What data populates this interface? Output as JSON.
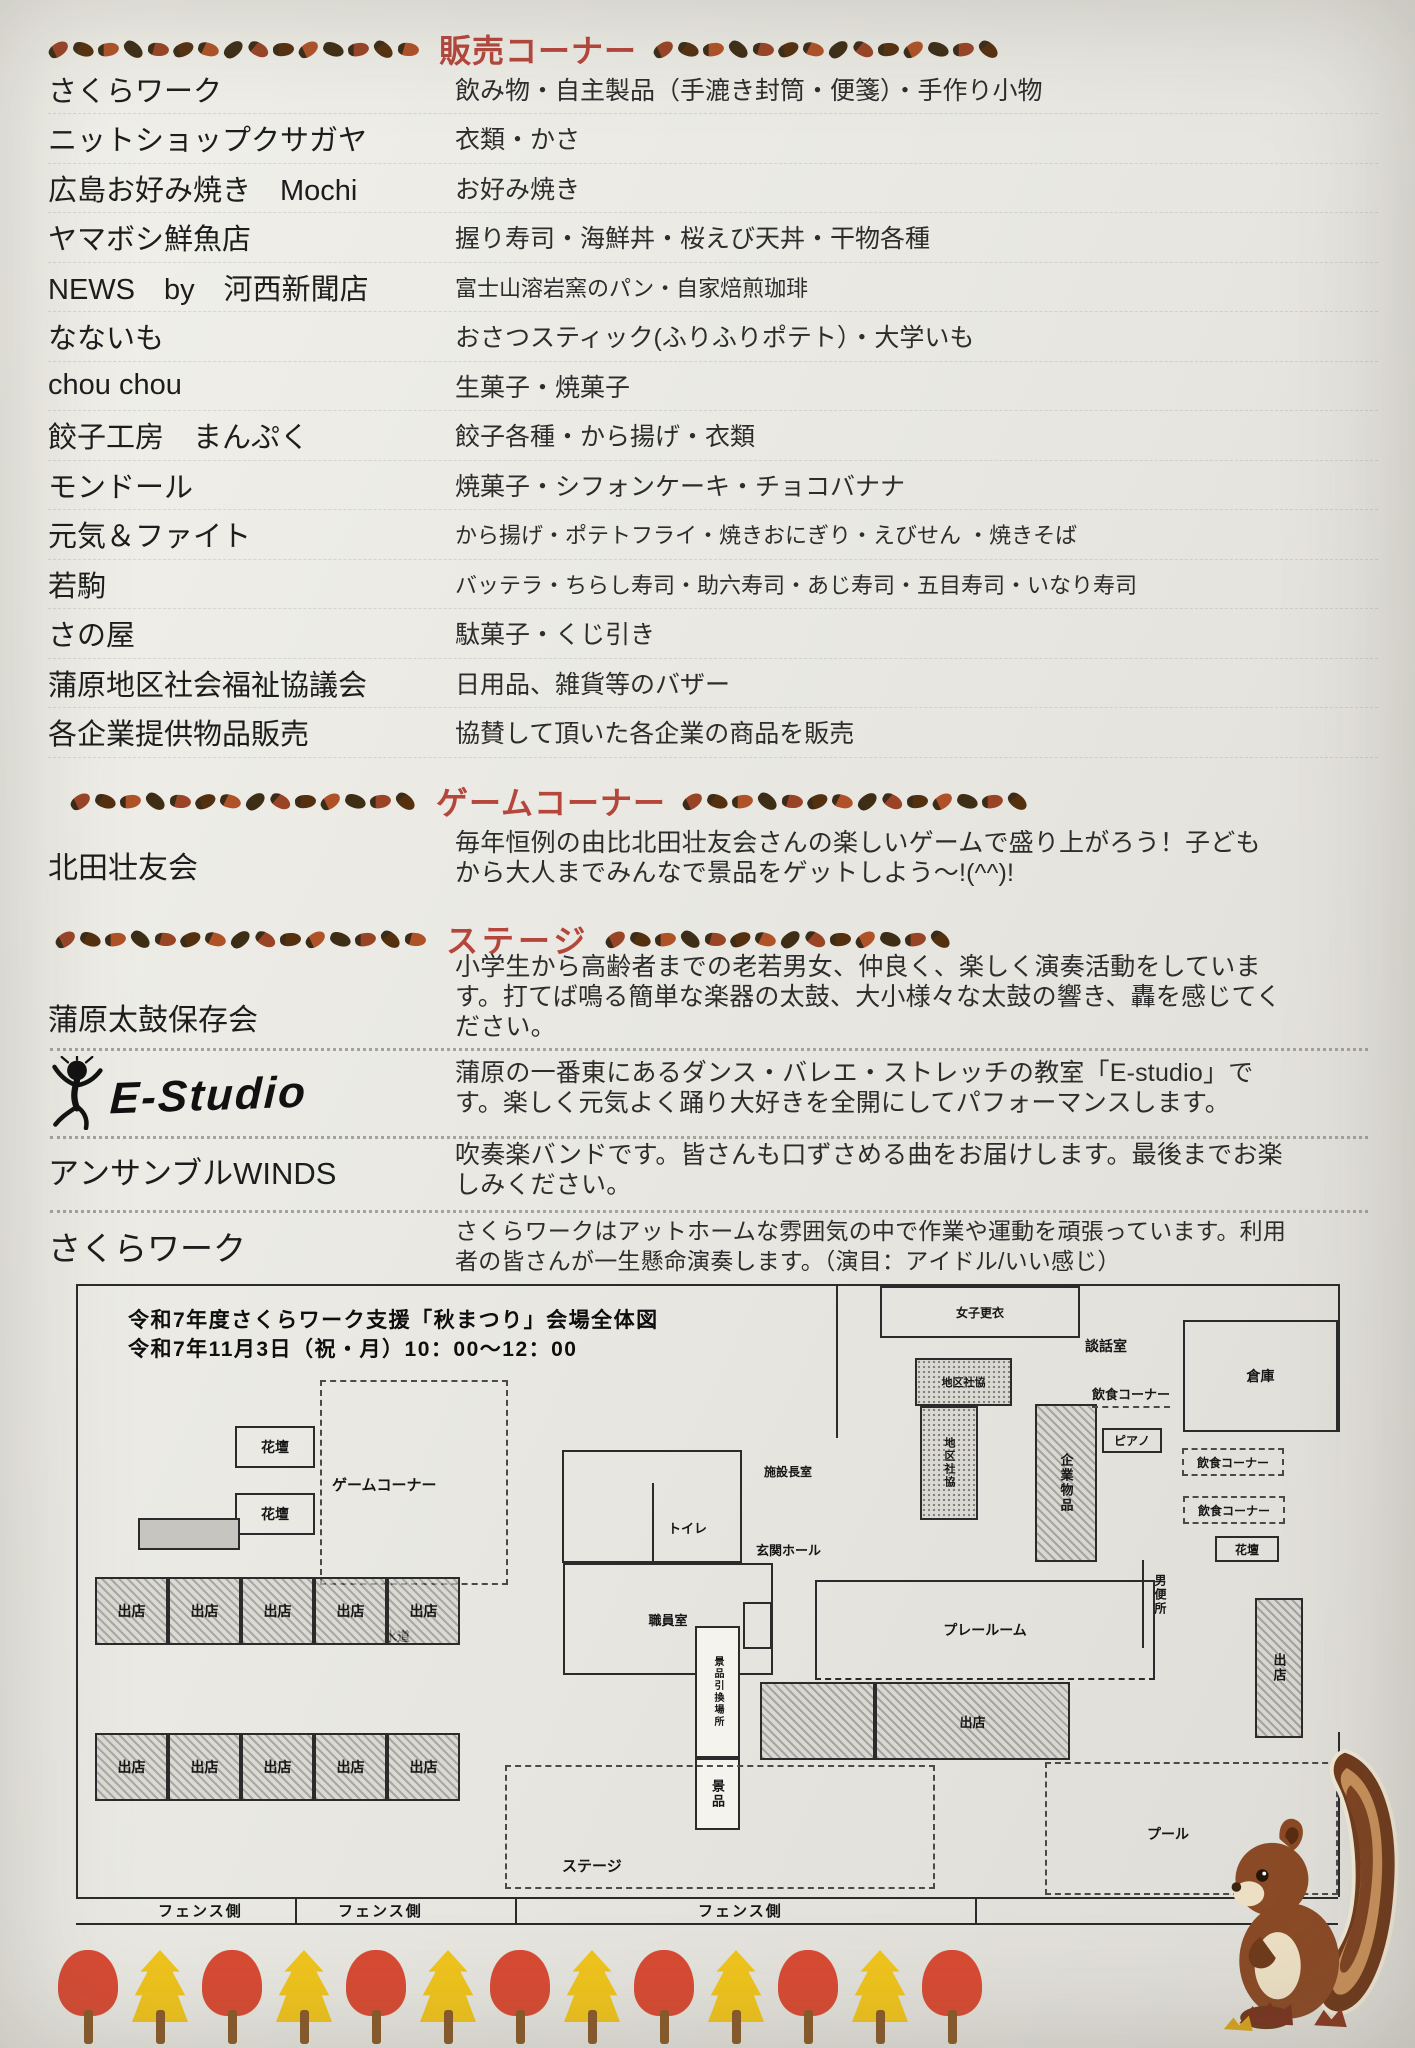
{
  "colors": {
    "paper": "#e9e8e2",
    "header_red": "#b5463c",
    "ink": "#222222",
    "map_line": "#2b2b2b",
    "tree_red": "#d84a33",
    "tree_yellow": "#f0c41c",
    "trunk_brown": "#8a5a2a",
    "acorn_palette": [
      "#9a4426",
      "#54300f",
      "#b05228",
      "#3f2e16"
    ],
    "squirrel_brown": "#8a4a26"
  },
  "sections": {
    "sales": {
      "title": "販売コーナー",
      "vendors": [
        {
          "name": "さくらワーク",
          "items": "飲み物・自主製品（手漉き封筒・便箋）・手作り小物"
        },
        {
          "name": "ニットショップクサガヤ",
          "items": "衣類・かさ"
        },
        {
          "name": "広島お好み焼き　Mochi",
          "items": "お好み焼き"
        },
        {
          "name": "ヤマボシ鮮魚店",
          "items": "握り寿司・海鮮丼・桜えび天丼・干物各種"
        },
        {
          "name": "NEWS　by　河西新聞店",
          "items": "富士山溶岩窯のパン・自家焙煎珈琲",
          "small": true
        },
        {
          "name": "なないも",
          "items": "おさつスティック(ふりふりポテト）・大学いも"
        },
        {
          "name": "chou chou",
          "items": "生菓子・焼菓子"
        },
        {
          "name": "餃子工房　まんぷく",
          "items": "餃子各種・から揚げ・衣類"
        },
        {
          "name": "モンドール",
          "items": "焼菓子・シフォンケーキ・チョコバナナ"
        },
        {
          "name": "元気＆ファイト",
          "items": "から揚げ・ポテトフライ・焼きおにぎり・えびせん ・焼きそば",
          "small": true
        },
        {
          "name": "若駒",
          "items": "バッテラ・ちらし寿司・助六寿司・あじ寿司・五目寿司・いなり寿司",
          "small": true
        },
        {
          "name": "さの屋",
          "items": "駄菓子・くじ引き"
        },
        {
          "name": "蒲原地区社会福祉協議会",
          "items": "日用品、雑貨等のバザー"
        },
        {
          "name": "各企業提供物品販売",
          "items": "協賛して頂いた各企業の商品を販売"
        }
      ]
    },
    "game": {
      "title": "ゲームコーナー",
      "performers": [
        {
          "name": "北田壮友会",
          "desc": "毎年恒例の由比北田壮友会さんの楽しいゲームで盛り上がろう！子どもから大人までみんなで景品をゲットしよう～!(^^)!"
        }
      ]
    },
    "stage": {
      "title": "ステージ",
      "performers": [
        {
          "name": "蒲原太鼓保存会",
          "desc": "小学生から高齢者までの老若男女、仲良く、楽しく演奏活動をしています。打てば鳴る簡単な楽器の太鼓、大小様々な太鼓の響き、轟を感じてください。"
        },
        {
          "name": "E-Studio",
          "logo": true,
          "logo_text": "E-Studio",
          "desc": "蒲原の一番東にあるダンス・バレエ・ストレッチの教室「E-studio」です。楽しく元気よく踊り大好きを全開にしてパフォーマンスします。"
        },
        {
          "name": "アンサンブルWINDS",
          "desc": "吹奏楽バンドです。皆さんも口ずさめる曲をお届けします。最後までお楽しみください。"
        },
        {
          "name": "さくらワーク",
          "desc": "さくらワークはアットホームな雰囲気の中で作業や運動を頑張っています。利用者の皆さんが一生懸命演奏します。（演目：アイドル/いい感じ）",
          "small": true
        }
      ]
    }
  },
  "map": {
    "title1": "令和7年度さくらワーク支援「秋まつり」会場全体図",
    "title2": "令和7年11月3日（祝・月）10：00～12：00",
    "stall_label": "出店",
    "fence_label": "フェンス側",
    "rooms": [
      {
        "label": "花壇",
        "x": 165,
        "y": 146,
        "w": 80,
        "h": 42,
        "s": "room",
        "fs": 14
      },
      {
        "label": "花壇",
        "x": 165,
        "y": 213,
        "w": 80,
        "h": 42,
        "s": "room",
        "fs": 14
      },
      {
        "label": "",
        "x": 68,
        "y": 238,
        "w": 102,
        "h": 32,
        "s": "gray"
      },
      {
        "label": "ゲームコーナー",
        "x": 250,
        "y": 100,
        "w": 188,
        "h": 205,
        "s": "dash",
        "fs": 15,
        "lx": 10,
        "ly": 92
      },
      {
        "label": "女子更衣",
        "x": 810,
        "y": 6,
        "w": 200,
        "h": 52,
        "s": "room",
        "fs": 12
      },
      {
        "label": "倉庫",
        "x": 1113,
        "y": 40,
        "w": 155,
        "h": 112,
        "s": "room",
        "fs": 14
      },
      {
        "label": "",
        "x": 492,
        "y": 170,
        "w": 180,
        "h": 113,
        "s": "room"
      },
      {
        "label": "職員室",
        "x": 493,
        "y": 283,
        "w": 210,
        "h": 112,
        "s": "room",
        "fs": 13
      },
      {
        "label": "",
        "x": 673,
        "y": 322,
        "w": 29,
        "h": 47,
        "s": "room"
      },
      {
        "label": "プレールーム",
        "x": 745,
        "y": 300,
        "w": 340,
        "h": 100,
        "s": "roomdb",
        "fs": 14
      },
      {
        "label": "地区社協",
        "x": 845,
        "y": 78,
        "w": 97,
        "h": 48,
        "s": "dots",
        "fs": 11
      },
      {
        "label": "地区社協",
        "x": 850,
        "y": 126,
        "w": 58,
        "h": 114,
        "s": "dots",
        "fs": 11,
        "v": true
      },
      {
        "label": "企業物品",
        "x": 965,
        "y": 124,
        "w": 62,
        "h": 158,
        "s": "hatch",
        "fs": 13,
        "v": true
      },
      {
        "label": "ピアノ",
        "x": 1032,
        "y": 148,
        "w": 60,
        "h": 25,
        "s": "room",
        "fs": 12
      },
      {
        "label": "飲食コーナー",
        "x": 1112,
        "y": 168,
        "w": 102,
        "h": 28,
        "s": "dash",
        "fs": 12
      },
      {
        "label": "飲食コーナー",
        "x": 1113,
        "y": 216,
        "w": 102,
        "h": 28,
        "s": "dash",
        "fs": 12
      },
      {
        "label": "花壇",
        "x": 1145,
        "y": 256,
        "w": 64,
        "h": 26,
        "s": "room",
        "fs": 12
      },
      {
        "label": "出店",
        "x": 1185,
        "y": 318,
        "w": 48,
        "h": 140,
        "s": "hatch",
        "fs": 13,
        "v": true
      },
      {
        "label": "",
        "x": 690,
        "y": 402,
        "w": 115,
        "h": 78,
        "s": "hatch"
      },
      {
        "label": "出店",
        "x": 805,
        "y": 402,
        "w": 195,
        "h": 78,
        "s": "hatch",
        "fs": 13
      },
      {
        "label": "景品引換場所",
        "x": 625,
        "y": 346,
        "w": 45,
        "h": 132,
        "s": "white",
        "fs": 10,
        "v": true
      },
      {
        "label": "景品",
        "x": 625,
        "y": 478,
        "w": 45,
        "h": 72,
        "s": "white",
        "fs": 13,
        "v": true
      },
      {
        "label": "ステージ",
        "x": 435,
        "y": 485,
        "w": 430,
        "h": 124,
        "s": "dash",
        "fs": 15,
        "lx": 55,
        "ly": 88
      },
      {
        "label": "プール",
        "x": 975,
        "y": 482,
        "w": 293,
        "h": 133,
        "s": "dash",
        "fs": 14,
        "lx": 100,
        "ly": 60
      }
    ],
    "labels": [
      {
        "t": "談話室",
        "x": 1015,
        "y": 56,
        "fs": 14
      },
      {
        "t": "飲食コーナー",
        "x": 1022,
        "y": 104,
        "fs": 13,
        "u": true
      },
      {
        "t": "施設長室",
        "x": 694,
        "y": 183,
        "fs": 12
      },
      {
        "t": "玄関ホール",
        "x": 686,
        "y": 260,
        "fs": 13
      },
      {
        "t": "トイレ",
        "x": 598,
        "y": 238,
        "fs": 13
      },
      {
        "t": "水道",
        "x": 314,
        "y": 346,
        "fs": 13
      },
      {
        "t": "男便所",
        "x": 1082,
        "y": 294,
        "fs": 12,
        "v": true
      }
    ],
    "stall_rows": [
      {
        "x": 25,
        "y": 297,
        "n": 5,
        "w": 73,
        "h": 68
      },
      {
        "x": 25,
        "y": 453,
        "n": 5,
        "w": 73,
        "h": 68
      }
    ],
    "fence": {
      "xs": [
        88,
        268,
        628
      ],
      "y": 620
    }
  },
  "decor": {
    "tree_pattern": [
      "red",
      "yellow",
      "red",
      "yellow",
      "red",
      "yellow",
      "red",
      "yellow",
      "red",
      "yellow",
      "red",
      "yellow",
      "red"
    ],
    "acorn_headers": [
      {
        "left": 15,
        "right": 14
      },
      {
        "left": 14,
        "right": 14
      },
      {
        "left": 15,
        "right": 14
      }
    ]
  }
}
